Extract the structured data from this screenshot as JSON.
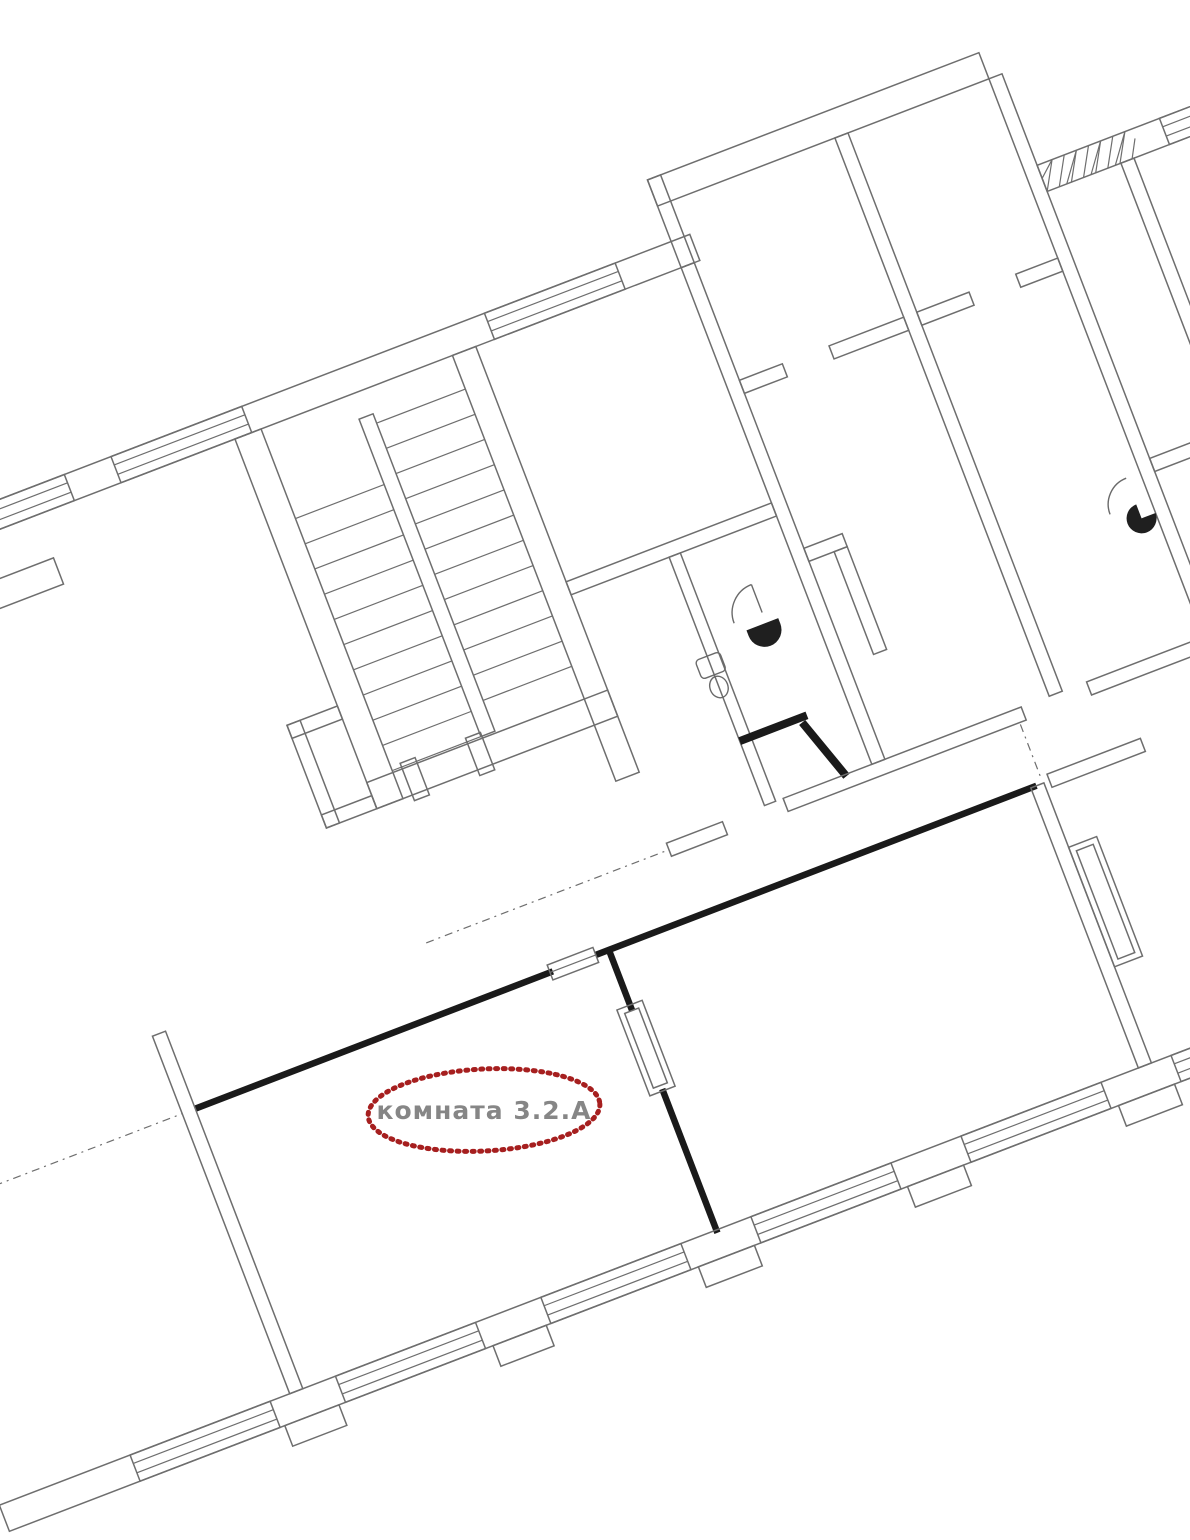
{
  "plan": {
    "type": "floor-plan",
    "rotation_deg": -21,
    "colors": {
      "background": "#ffffff",
      "wall_line": "#6e6e6e",
      "highlight_wall": "#1a1a1a",
      "annotation_ellipse": "#a61f1f",
      "annotation_label": "#868686"
    },
    "annotation": {
      "room_label": "комната 3.2.А"
    },
    "features": {
      "staircase": "two-flight staircase",
      "highlighted_room": "room outlined with thick black walls",
      "window_symbols": "multi-line window symbols on exterior walls",
      "hatched_wall": "cross-hatched wall section top right",
      "fixtures": "toilet and sink in WC, door swing arcs"
    }
  }
}
